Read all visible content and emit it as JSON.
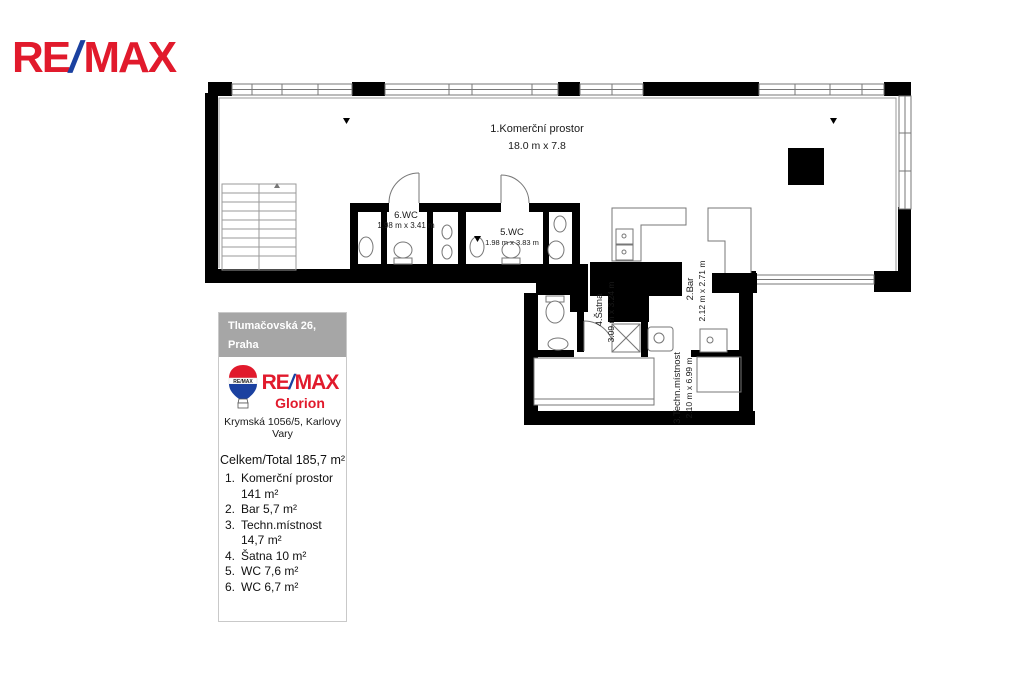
{
  "brand": {
    "re": "RE",
    "slash": "/",
    "max": "MAX",
    "red": "#e11a2c",
    "blue": "#1b41a0"
  },
  "floorplan": {
    "rooms": [
      {
        "name": "1.Komerční prostor",
        "dims": "18.0 m x 7.8"
      },
      {
        "name": "6.WC",
        "dims": "1.98 m x 3.41 m"
      },
      {
        "name": "5.WC",
        "dims": "1.98 m x 3.83 m"
      },
      {
        "name": "4.Šatna",
        "dims": "3.09 m x 3.24 m"
      },
      {
        "name": "2.Bar",
        "dims": "2.12 m x 2.71 m"
      },
      {
        "name": "3.Techn.místnost",
        "dims": "2.10 m x 6.99 m"
      }
    ]
  },
  "panel": {
    "address_box": {
      "line1": "Tlumačovská 26,",
      "line2": "Praha"
    },
    "agency": {
      "balloon_text": "RE/MAX",
      "wordmark_re": "RE",
      "wordmark_slash": "/",
      "wordmark_max": "MAX",
      "name": "Glorion",
      "office_address": "Krymská 1056/5, Karlovy Vary"
    },
    "totals": {
      "title": "Celkem/Total 185,7 m²",
      "items": [
        {
          "num": "1.",
          "label": "Komerční prostor 141 m²"
        },
        {
          "num": "2.",
          "label": "Bar 5,7 m²"
        },
        {
          "num": "3.",
          "label": "Techn.místnost 14,7 m²"
        },
        {
          "num": "4.",
          "label": "Šatna 10 m²"
        },
        {
          "num": "5.",
          "label": "WC 7,6 m²"
        },
        {
          "num": "6.",
          "label": "WC 6,7 m²"
        }
      ]
    }
  }
}
